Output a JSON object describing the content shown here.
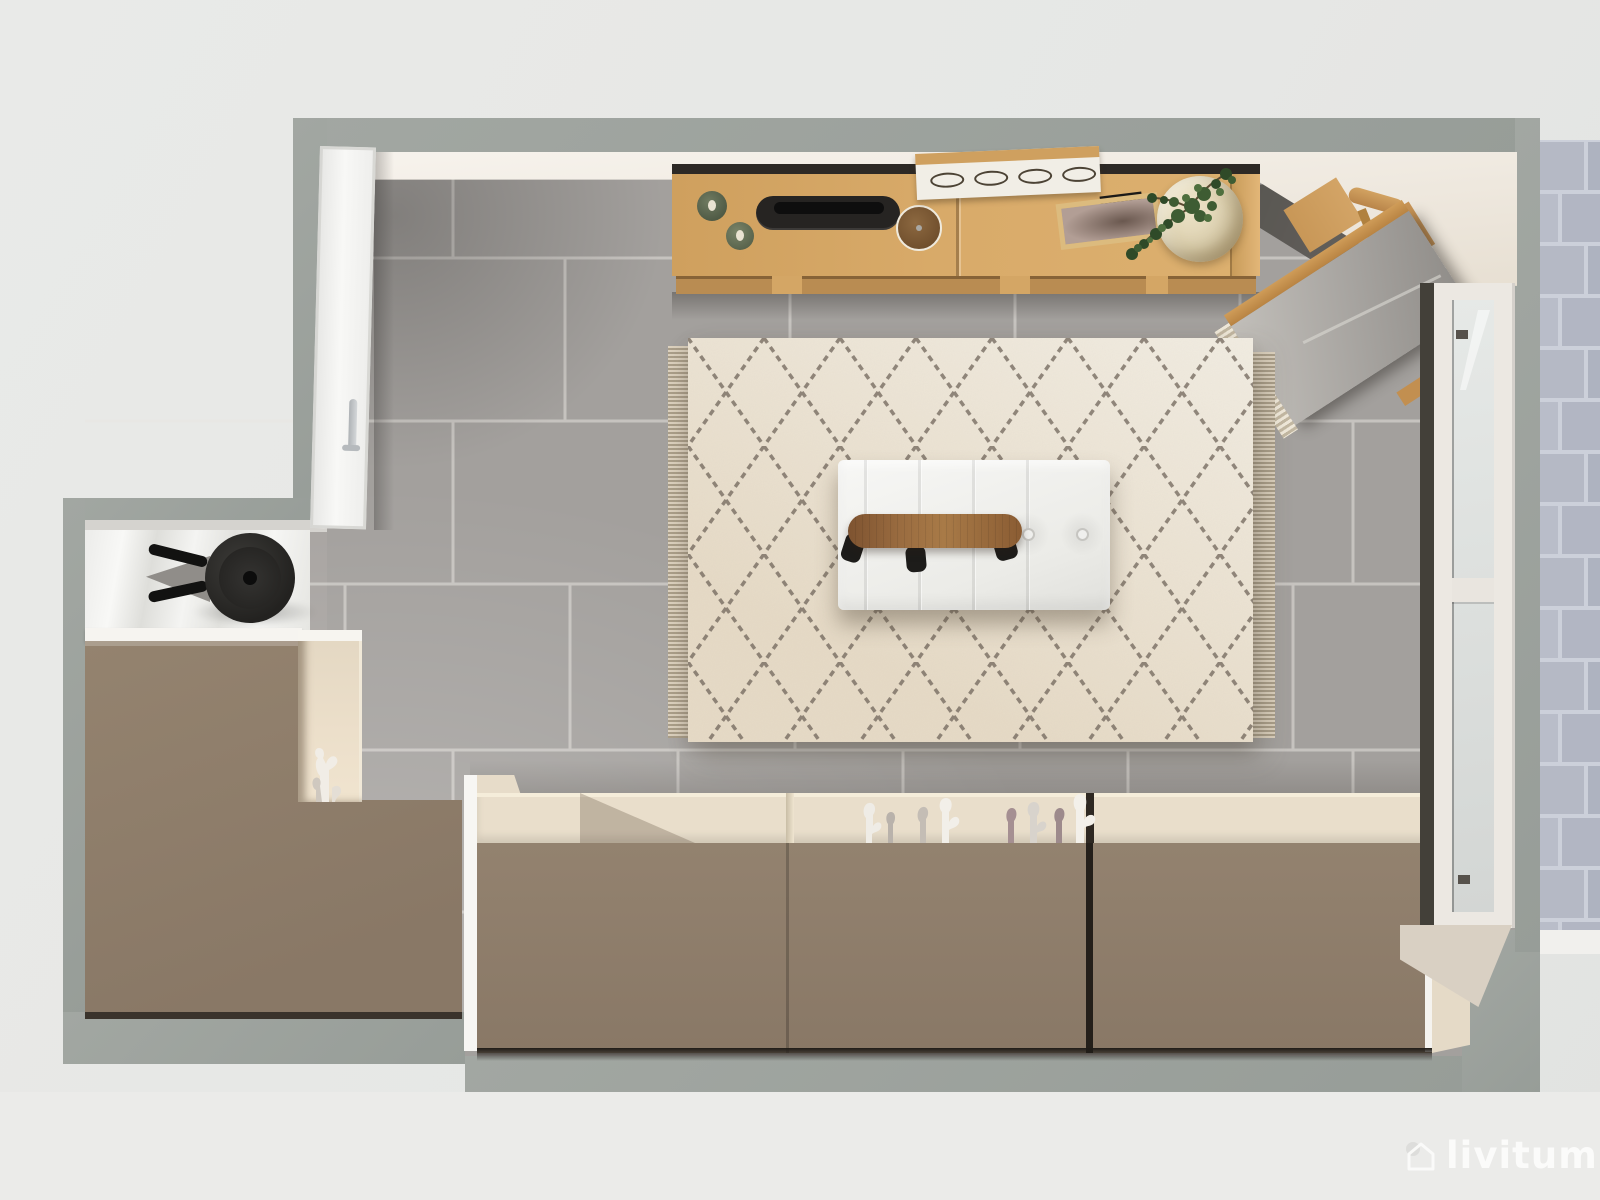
{
  "watermark": {
    "text": "livitum",
    "icon": "house-logo-icon",
    "color": "#fbfbfa"
  },
  "palette": {
    "background": "#e7e8e6",
    "wall_gray": "#9aa09b",
    "wall_inner_face": "#f6f2ec",
    "floor_tile_gray": "#a3a09d",
    "floor_grout": "#e9e6e2",
    "floor_shadow_corner": "#55524e",
    "rug_cream": "#ece6da",
    "rug_pattern_line": "#6e6358",
    "rug_fringe": "#d8cdbb",
    "ottoman_white": "#f3f3f1",
    "bench_walnut": "#9a6c40",
    "sideboard_oak": "#d5a765",
    "cabinet_taupe": "#8d7c6c",
    "shelf_cream": "#e9decb",
    "tray_black": "#242220",
    "plant_green": "#3e5c33",
    "pot_cream": "#dbcfae",
    "door_white": "#f4f4f2",
    "window_frame_white": "#ece8e2",
    "outdoor_tile_lavender": "#b6bac6",
    "outdoor_curb_white": "#f1f0ed"
  },
  "scene": {
    "type": "top-down 3D interior render (floor plan view)",
    "room": "living room with terrace door",
    "furniture": [
      {
        "id": "oak-sideboard",
        "label": "oak sideboard with decor",
        "color": "#d5a765"
      },
      {
        "id": "green-dishes",
        "label": "two sage ceramic dishes",
        "color": "#5f6a54"
      },
      {
        "id": "black-tray",
        "label": "black serving tray",
        "color": "#242220"
      },
      {
        "id": "wood-clock",
        "label": "round walnut clock",
        "color": "#7e5a35"
      },
      {
        "id": "slatted-panel",
        "label": "white leaning panel with oval cutouts",
        "color": "#f1eee6"
      },
      {
        "id": "picture-frame",
        "label": "framed photo lying flat",
        "color": "#dcbb7e"
      },
      {
        "id": "potted-plant",
        "label": "green plant in sculpted cream pot",
        "color": "#3e5c33"
      },
      {
        "id": "wooden-chair",
        "label": "wooden chair (diagonal, corner)",
        "color": "#c89757"
      },
      {
        "id": "gray-lounger",
        "label": "gray lounger with fringed throw",
        "color": "#a5a29e"
      },
      {
        "id": "berber-rug",
        "label": "cream berber rug with diamond lattice and fringe",
        "color": "#ece6da"
      },
      {
        "id": "white-ottoman",
        "label": "white tufted ottoman daybed",
        "color": "#f3f3f1"
      },
      {
        "id": "walnut-bench",
        "label": "walnut bench with black legs",
        "color": "#9a6c40"
      },
      {
        "id": "black-fan",
        "label": "black table fan",
        "color": "#262524"
      },
      {
        "id": "white-door",
        "label": "white interior door with steel handle",
        "color": "#f4f4f2"
      },
      {
        "id": "taupe-desk",
        "label": "taupe desk / worktop (L-shaped)",
        "color": "#8d7c6c"
      },
      {
        "id": "cream-cubby",
        "label": "cream display cubby with white coral sculpture",
        "color": "#e8ddca"
      },
      {
        "id": "taupe-cabinet-row",
        "label": "long taupe cabinet row with cream shelf",
        "color": "#8d7c6c"
      },
      {
        "id": "ceramic-sculptures",
        "label": "white and mauve ceramic sculptures",
        "color": "#f0ece6"
      },
      {
        "id": "french-window",
        "label": "white french window to terrace",
        "color": "#ece8e2"
      },
      {
        "id": "terrace-tiles",
        "label": "lavender-gray terrace pavers",
        "color": "#b6bac6"
      }
    ]
  }
}
